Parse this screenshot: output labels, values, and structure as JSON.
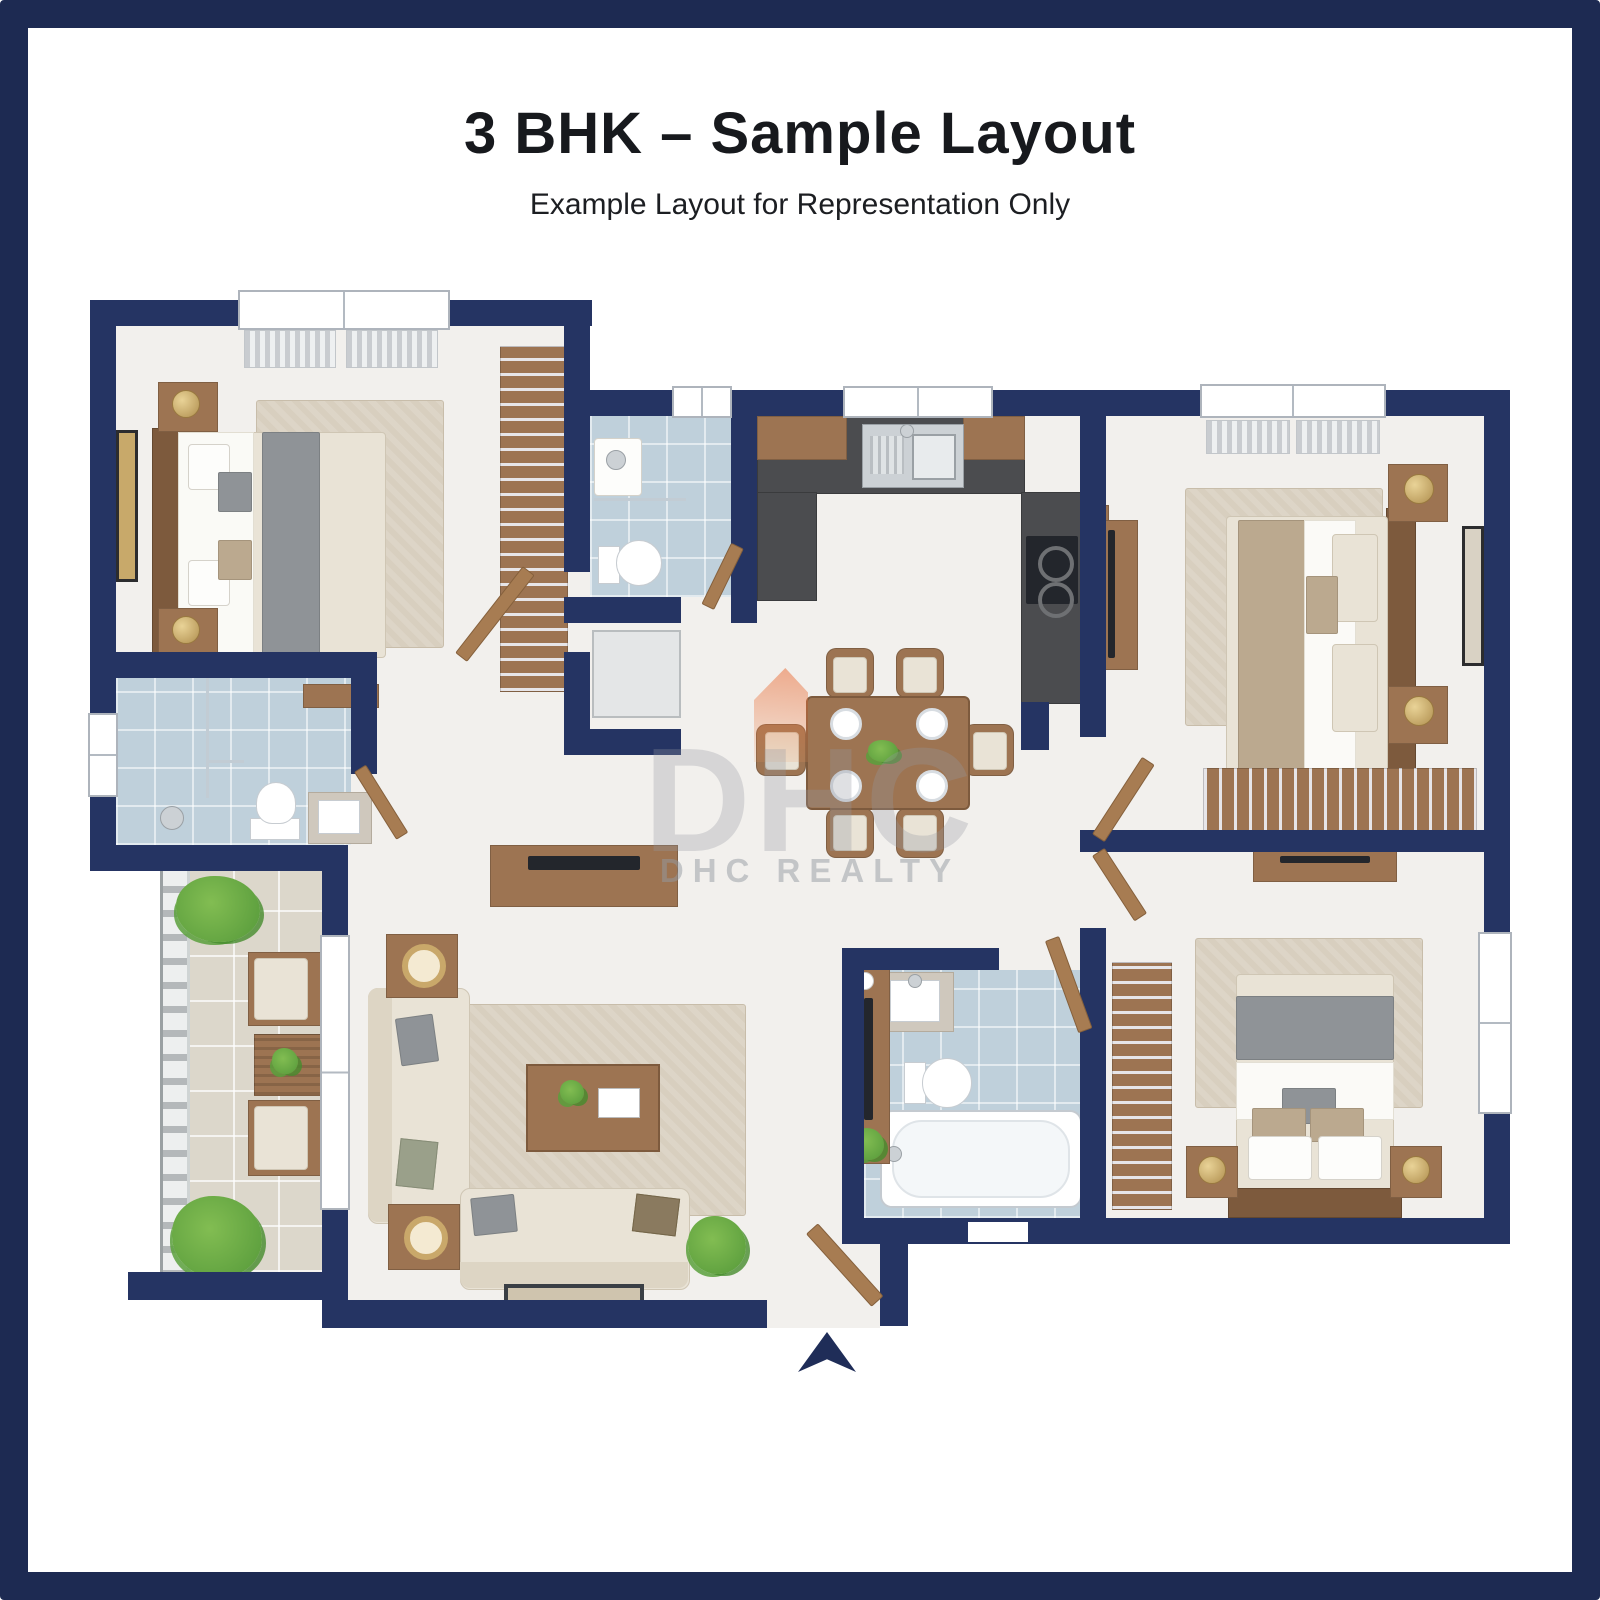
{
  "header": {
    "title": "3 BHK – Sample Layout",
    "subtitle": "Example Layout for Representation Only"
  },
  "watermark": {
    "brand": "DHC",
    "label": "DHC REALTY"
  },
  "entry": {
    "marker": "entry-arrow",
    "direction": "up"
  },
  "colors": {
    "frame": "#1d2a52",
    "wall": "#253463",
    "arrow": "#1f2d58",
    "floor": "#f2f0ed",
    "tile_blue": "#bfd0db",
    "tile_balcony": "#dcd7cb",
    "rug": "#d8cfbf",
    "wood": "#9d7452",
    "wood_dark": "#7d5a3d",
    "counter": "#4b4c4f",
    "fabric_cream": "#e9e3d6",
    "blanket_gray": "#8f9397",
    "accent_orange": "#e8703c",
    "plant_green": "#55993a",
    "gold": "#c9a86a",
    "window_frame": "#aeb4bc",
    "watermark_gray": "#979ca6"
  }
}
